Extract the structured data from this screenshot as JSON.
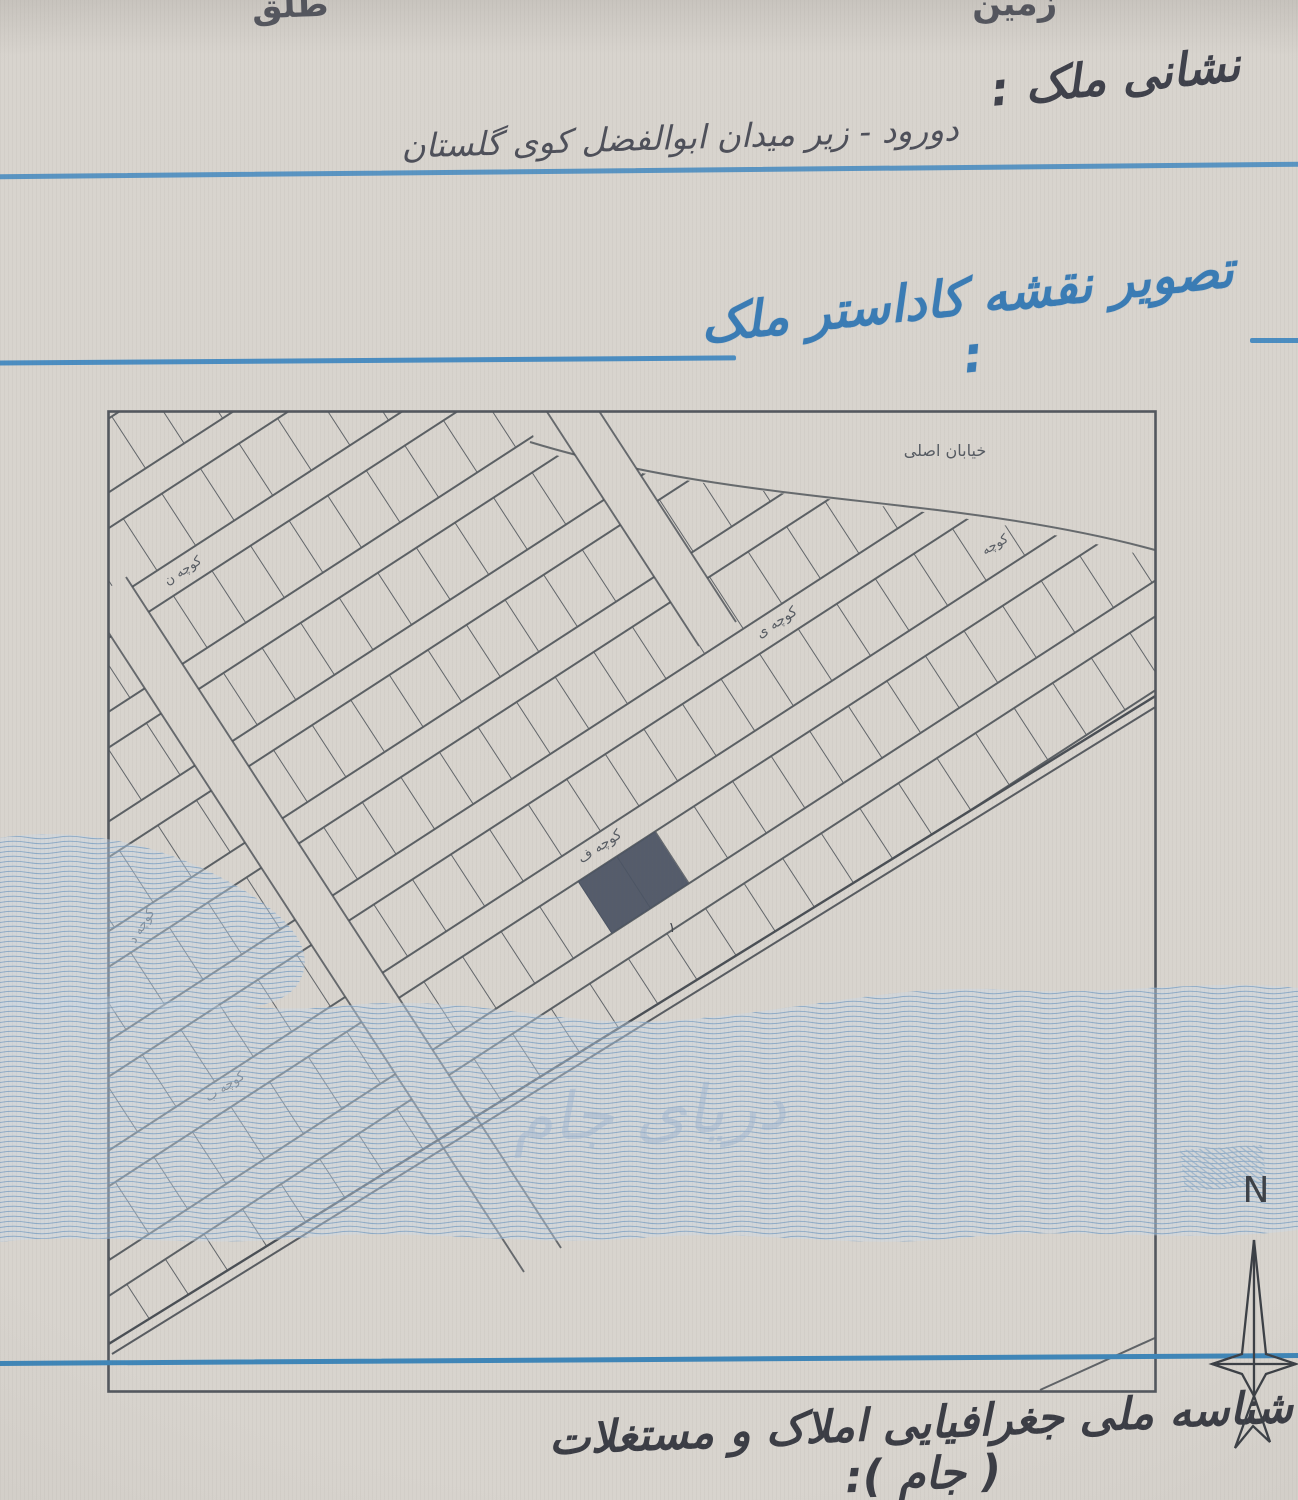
{
  "page": {
    "corner_top_left": "طلق",
    "corner_top_right": "زمین",
    "address": {
      "label": "نشانی ملک :",
      "value": "دورود - زیر میدان ابوالفضل  کوی گلستان"
    },
    "map_section": {
      "heading": "تصویر نقشه کاداستر ملک :"
    },
    "footer": {
      "heading": "شناسه ملی جغرافیایی املاک و مستغلات ( جام ):"
    }
  },
  "map": {
    "street_labels": {
      "main_street": "خیابان اصلی",
      "alley_plain": "کوچه",
      "alley_n": "کوچه ن",
      "alley_y": "کوچه ی",
      "alley_f": "کوچه ف",
      "alley_d": "کوچه د",
      "alley_b": "کوچه ب"
    },
    "parcel_number": "۱",
    "compass": {
      "north_label": "N"
    },
    "watermark_text": "دریای جام"
  },
  "colors": {
    "paper": "#d8d4ce",
    "ink_dark": "#45474f",
    "ink_blue": "#3a7cb5",
    "rule_blue": "#4b8dc1",
    "map_line": "#4a4f55",
    "parcel_highlight": "#4a5363",
    "watermark_band": "#c9d9ea",
    "watermark_line": "#7fa3c6"
  }
}
